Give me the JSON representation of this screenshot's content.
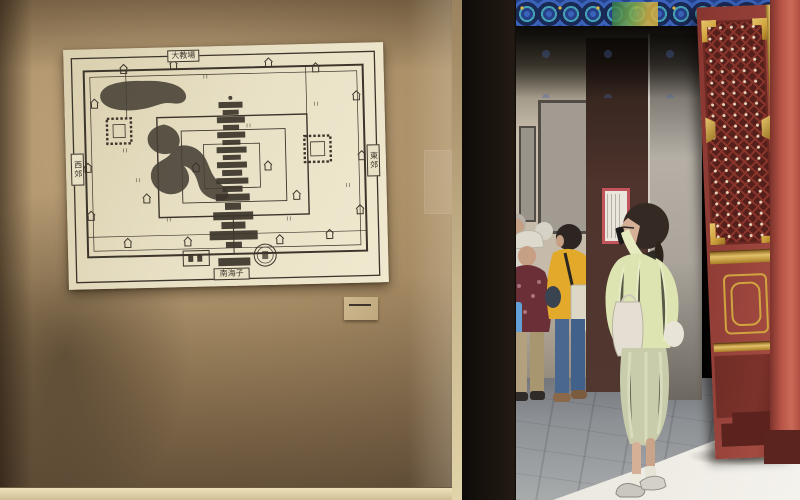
{
  "scene": {
    "setting": "museum-exhibit-photo",
    "artwork_labels": {
      "top": "大教場",
      "left": "西郊",
      "right": "東郊",
      "bottom": "南海子"
    }
  },
  "colors": {
    "wall-dark": "#6e5a44",
    "wall-mid": "#a58a63",
    "wall-light": "#c9ae84",
    "paper": "#e9e1c6",
    "ink": "#3c352b",
    "case-frame": "#17120d",
    "beam-blue": "#3a62b8",
    "beam-cyan": "#46a0b4",
    "beam-green": "#2f7a4e",
    "beam-gold": "#d9b23f",
    "backwall": "#c6bbaa",
    "pillar-maroon": "#4e342c",
    "doorframe-gray": "#aaa49b",
    "poster-red": "#c2545c",
    "poster-paper": "#eae6de",
    "door-red": "#95413a",
    "door-lattice-dark": "#551f1b",
    "door-lattice-red": "#8a352c",
    "door-gold": "#d0a43e",
    "jamb-red": "#b85548",
    "floor-gray": "#8d9094",
    "floor-light": "#a8abac",
    "sun-white": "#f4f2ec",
    "skin": "#d6b096",
    "hair-dark": "#352a23",
    "cardigan": "#dde4b2",
    "skirt-sage": "#c8ccab",
    "tote-white": "#e4dfd2",
    "hat-white": "#ddd9cc",
    "top-maroon": "#6b3037",
    "pants-beige": "#b2a07f",
    "bag-blue": "#63a0d6",
    "top-yellow": "#e2a92a",
    "jeans-blue": "#4a688f",
    "shoe-brown": "#8a6848"
  }
}
